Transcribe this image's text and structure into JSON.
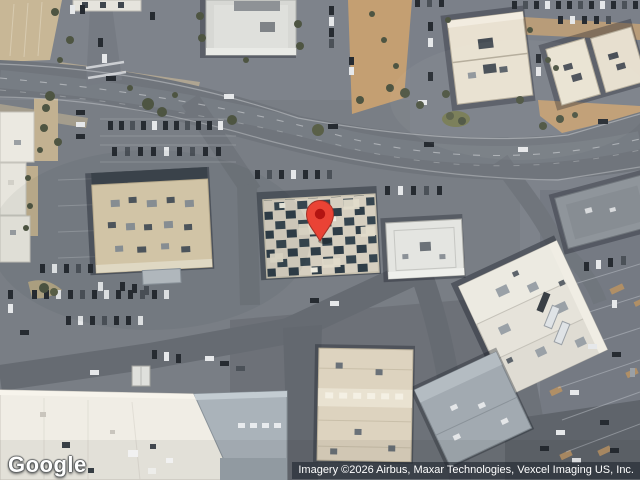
{
  "map": {
    "logo_text": "Google",
    "attribution_text": "Imagery ©2026 Airbus, Maxar Technologies, Vexcel Imaging US, Inc.",
    "marker": {
      "icon": "map-pin-icon",
      "color": "#EA4335",
      "inner_color": "#B31412"
    }
  }
}
